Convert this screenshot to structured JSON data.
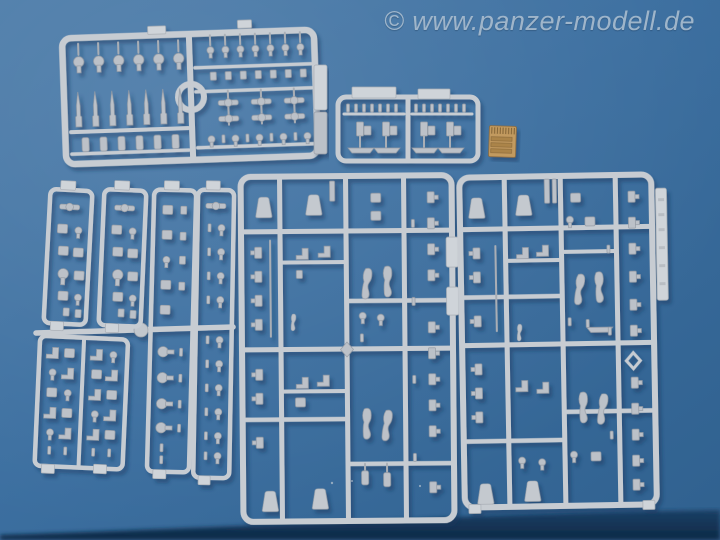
{
  "scene": {
    "type": "photograph",
    "description": "Top-down photo of grey injection-moulded model kit sprues (part trees) and one small photo-etched brass fret laid out on a blue tabletop",
    "sprue_count": 8,
    "photoetch_count": 1
  },
  "watermark": {
    "text": "© www.panzer-modell.de"
  },
  "colors": {
    "table_blue_light": "#4a7aa8",
    "table_blue_mid": "#3c6fa0",
    "table_blue_dark": "#30618f",
    "table_edge_dark": "#0d2946",
    "sprue_runner_grey": "#c7ccd2",
    "part_grey": "#bcc1c8",
    "flat_tab_grey": "#cfd4d9",
    "photoetch_brass": "#c29a5e",
    "watermark_blue_grey": "#a7bbce"
  },
  "objects": [
    {
      "name": "sprue-large-top-left",
      "description": "wide sprue with round knob parts, pointed gun barrels and cylinder parts, ring in centre"
    },
    {
      "name": "sprue-small-top-middle",
      "description": "small sprue with tooth strip and four weapon assemblies"
    },
    {
      "name": "photoetch-fret",
      "description": "small golden photo-etched brass fret with comb teeth"
    },
    {
      "name": "sprue-strip-1",
      "description": "narrow vertical ladder sprue with small fittings"
    },
    {
      "name": "sprue-strip-2",
      "description": "narrow vertical ladder sprue with small fittings"
    },
    {
      "name": "sprue-strip-3",
      "description": "long narrow sprue with round-head pins"
    },
    {
      "name": "sprue-strip-4",
      "description": "long narrow sprue with paired small parts"
    },
    {
      "name": "sprue-ladder-bottom-left",
      "description": "two-column ladder sprue full of small brackets"
    },
    {
      "name": "sprue-large-center",
      "description": "large grid sprue with funnel parts, legs and clip parts"
    },
    {
      "name": "sprue-large-right",
      "description": "large grid sprue with funnel parts, legs, clips and embossed side tab"
    }
  ]
}
